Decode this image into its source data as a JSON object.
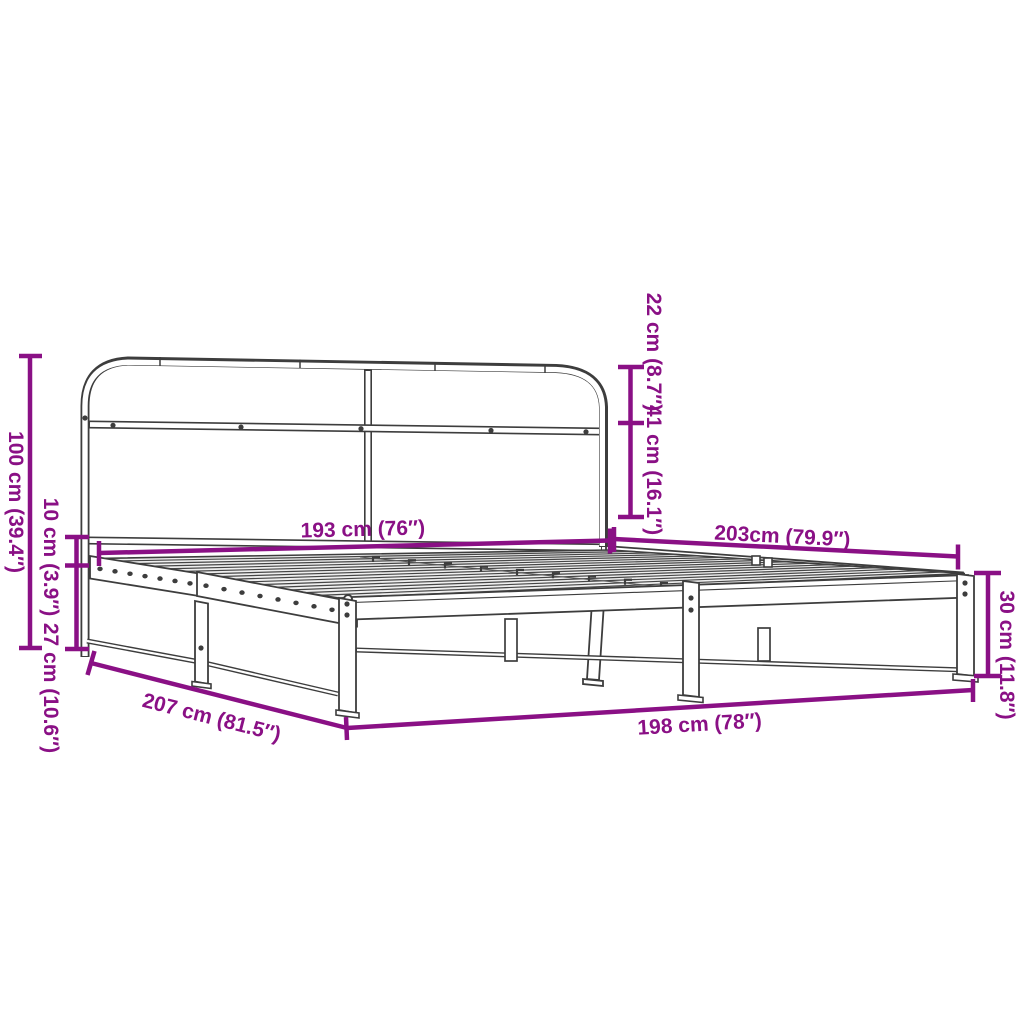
{
  "title": "Metal bed frame with headboard - dimension diagram",
  "colors": {
    "dimension_accent": "#8a1085",
    "line_art": "#3d3d3d",
    "deck_fill": "#efefef",
    "background": "#ffffff"
  },
  "dimensions": {
    "headboard_height": "100 cm (39.4″)",
    "rail_top_offset": "10 cm (3.9″)",
    "rail_to_floor": "27 cm (10.6″)",
    "headboard_top_section": "22 cm (8.7″)",
    "headboard_mid_section": "41 cm (16.1″)",
    "headboard_width": "193 cm (76″)",
    "frame_length": "203cm (79.9″)",
    "frame_height": "30 cm (11.8″)",
    "total_length": "207 cm (81.5″)",
    "frame_width": "198 cm (78″)"
  }
}
